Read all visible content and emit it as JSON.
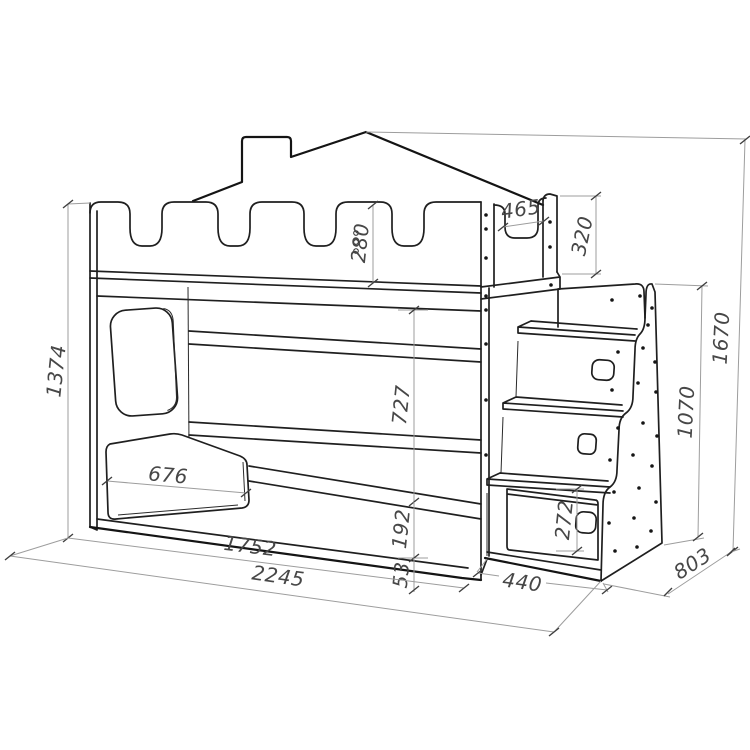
{
  "drawing": {
    "background": "#ffffff",
    "line_color": "#1f1f1f",
    "dimension_line_color": "#9d9d9d",
    "dimension_text_color": "#474747"
  },
  "dimensions": {
    "bed_height": "1374",
    "rail_height": "280",
    "end_cutout_width": "465",
    "end_cutout_depth": "320",
    "total_height": "1670",
    "under_bunk_clearance": "727",
    "lower_guard_width": "676",
    "base_height": "192",
    "plinth_height": "53",
    "bed_length": "1752",
    "total_length": "2245",
    "stair_depth": "440",
    "drawer_height": "272",
    "stair_unit_height": "1070",
    "bed_depth": "803"
  }
}
